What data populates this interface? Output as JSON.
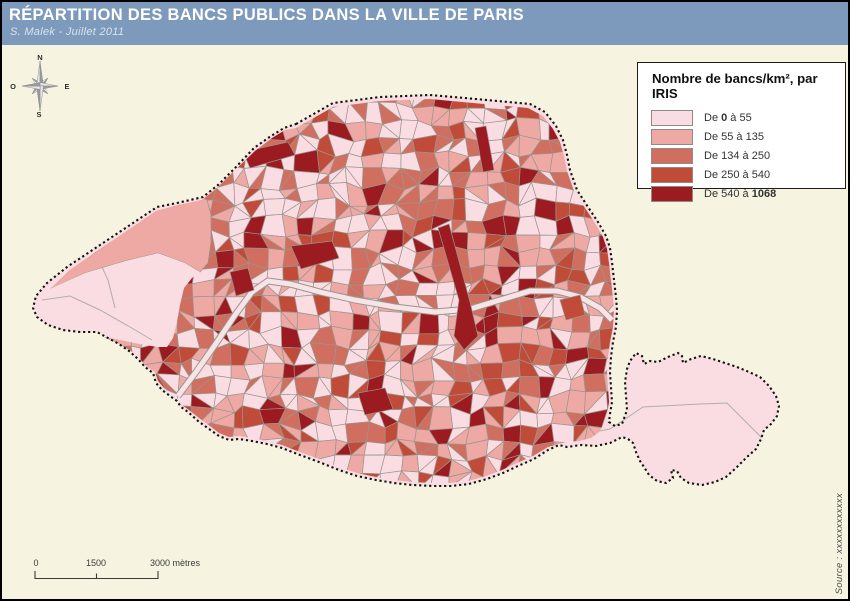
{
  "header": {
    "title": "RÉPARTITION DES BANCS PUBLICS DANS LA VILLE DE PARIS",
    "subtitle": "S. Malek - Juillet 2011",
    "bg_color": "#7d99bb",
    "title_color": "#ffffff",
    "subtitle_color": "#d9e3f0"
  },
  "legend": {
    "title": "Nombre de bancs/km², par IRIS",
    "items": [
      {
        "label_prefix": "De",
        "from": "0",
        "connector": "à",
        "to": "55",
        "from_bold": true,
        "to_bold": false,
        "color": "#f9dde2"
      },
      {
        "label_prefix": "De",
        "from": "55",
        "connector": "à",
        "to": "135",
        "from_bold": false,
        "to_bold": false,
        "color": "#efa9a4"
      },
      {
        "label_prefix": "De",
        "from": "134",
        "connector": "à",
        "to": "250",
        "from_bold": false,
        "to_bold": false,
        "color": "#d06f5f"
      },
      {
        "label_prefix": "De",
        "from": "250",
        "connector": "à",
        "to": "540",
        "from_bold": false,
        "to_bold": false,
        "color": "#c04b38"
      },
      {
        "label_prefix": "De",
        "from": "540",
        "connector": "à",
        "to": "1068",
        "from_bold": false,
        "to_bold": true,
        "color": "#9c1b21"
      }
    ]
  },
  "compass": {
    "north": "N",
    "east": "E",
    "south": "S",
    "west": "O"
  },
  "scale_bar": {
    "labels": [
      "0",
      "1500",
      "3000 mètres"
    ]
  },
  "source": "Source : xxxxxxxxxxxx",
  "map": {
    "background_color": "#f6f4e1",
    "park_color": "#f9dde2",
    "boundary_color": "#141414",
    "cell_border_color": "#9a948e",
    "water_color": "#f7e4e6",
    "road_color": "#b3ada6",
    "class_colors": [
      "#f9dde2",
      "#efa9a4",
      "#d06f5f",
      "#c04b38",
      "#9c1b21"
    ]
  }
}
